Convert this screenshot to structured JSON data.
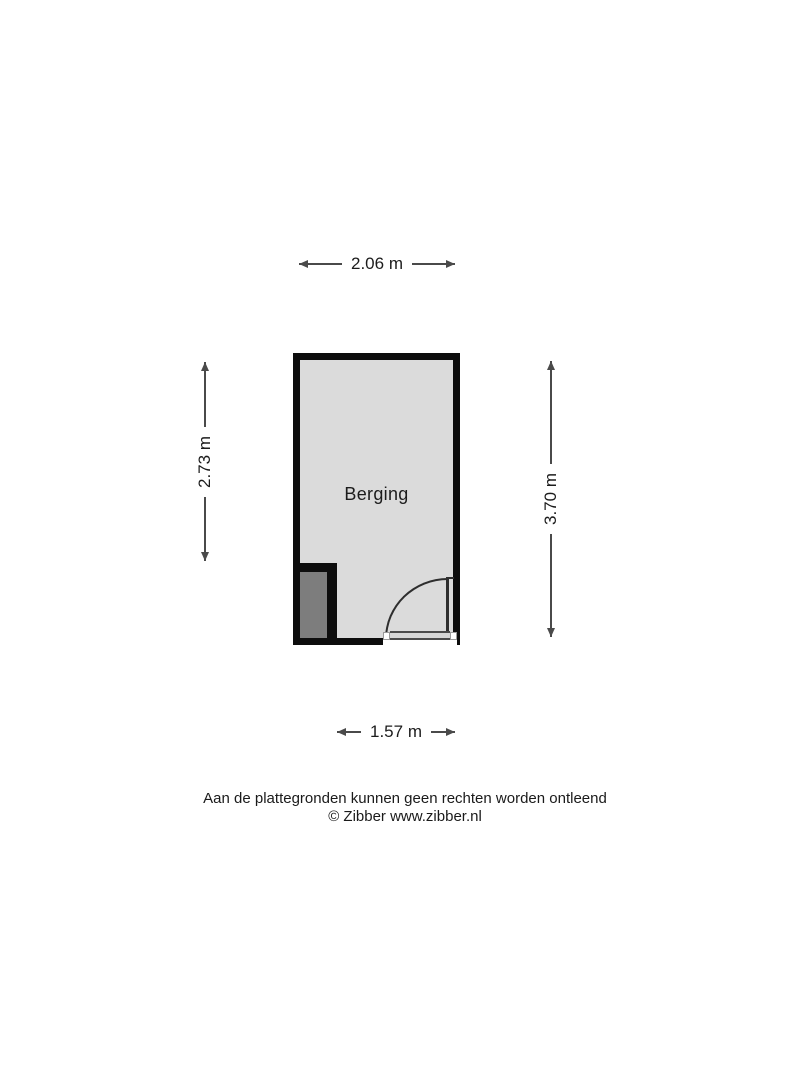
{
  "floorplan": {
    "room": {
      "label": "Berging"
    },
    "dimensions": {
      "top": {
        "label": "2.06 m"
      },
      "left": {
        "label": "2.73 m"
      },
      "right": {
        "label": "3.70 m"
      },
      "bottom": {
        "label": "1.57 m"
      }
    },
    "colors": {
      "wall": "#0d0d0d",
      "room_fill": "#dbdbdb",
      "shaft_fill": "#7d7d7d",
      "dimension_line": "#4a4a4a",
      "text": "#1c1c1c"
    }
  },
  "footer": {
    "disclaimer": "Aan de plattegronden kunnen geen rechten worden ontleend",
    "credit": "© Zibber www.zibber.nl"
  }
}
